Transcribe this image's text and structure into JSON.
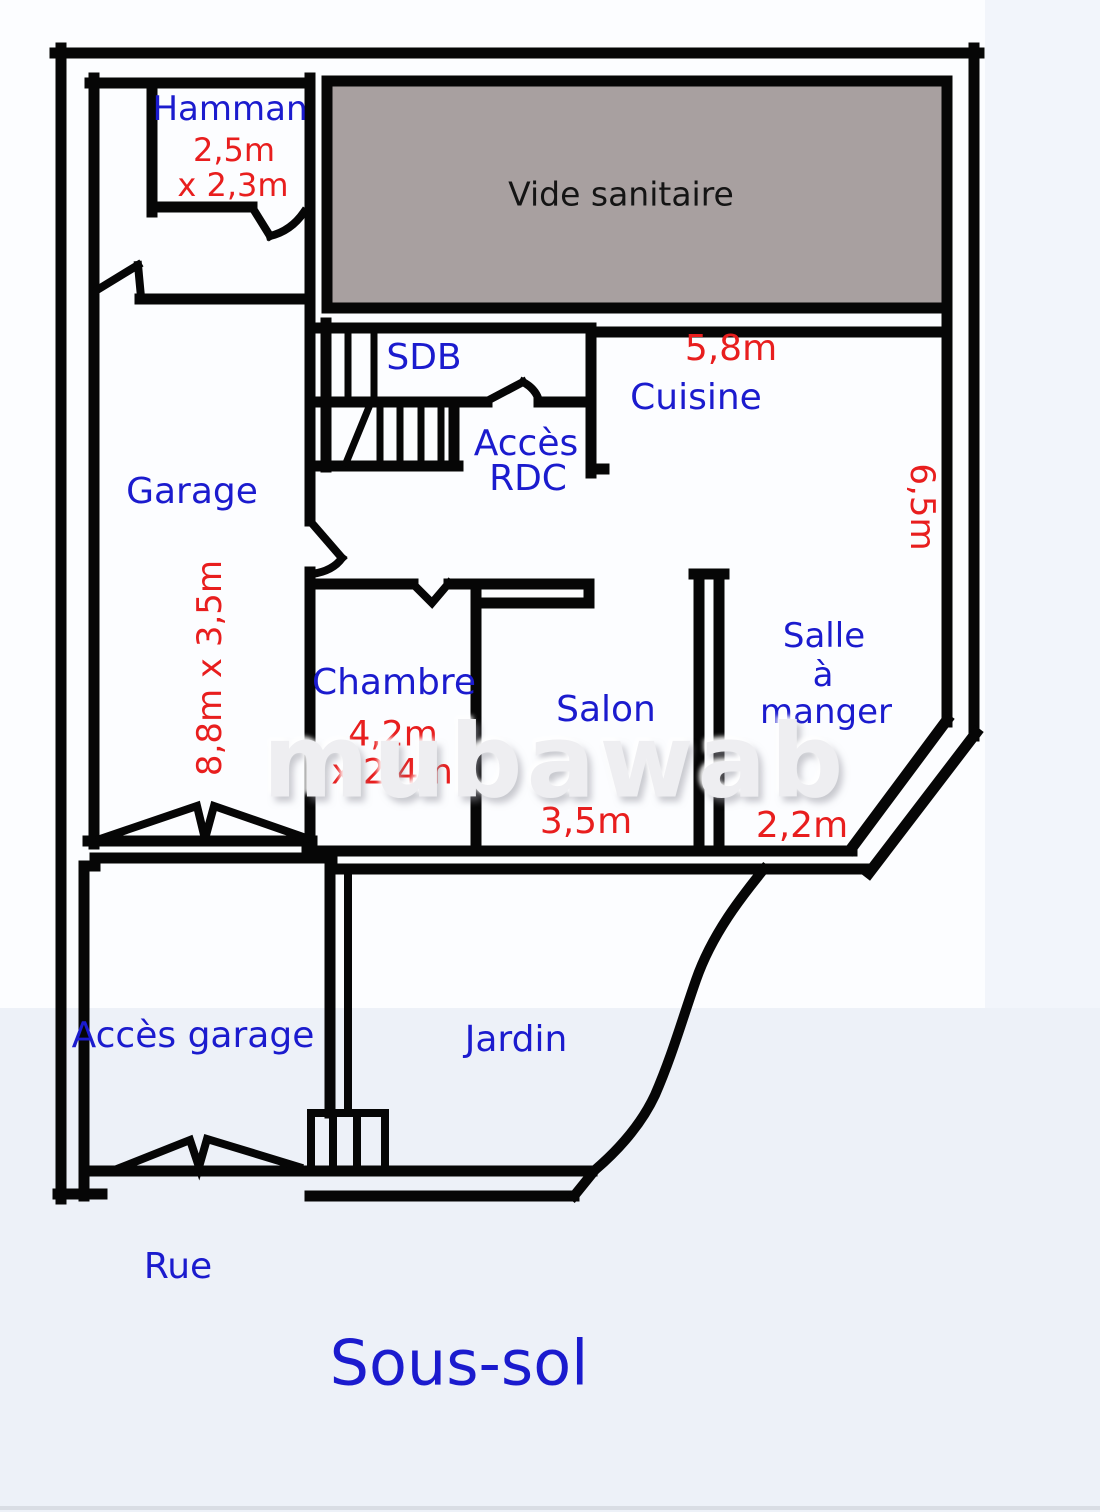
{
  "title": "Sous-sol",
  "watermark": "mubawab",
  "colors": {
    "room_label_blue": "#1b1bce",
    "dimension_red": "#e81e1e",
    "wall_black": "#060606",
    "vide_sanitaire_fill": "#a8a0a0",
    "vide_sanitaire_label": "#141414",
    "background_tint": "#edf1f8"
  },
  "rooms": {
    "hamman": {
      "name": "Hamman",
      "dim_line1": "2,5m",
      "dim_line2": "x 2,3m"
    },
    "vide_sanitaire": {
      "name": "Vide sanitaire"
    },
    "sdb": {
      "name": "SDB"
    },
    "acces_rdc": {
      "line1": "Accès",
      "line2": "RDC"
    },
    "cuisine": {
      "name": "Cuisine",
      "width": "5,8m",
      "depth": "6,5m"
    },
    "garage": {
      "name": "Garage",
      "dims": "8,8m x 3,5m"
    },
    "chambre": {
      "name": "Chambre",
      "dim_line1": "4,2m",
      "dim_line2": "x 2,4m"
    },
    "salon": {
      "name": "Salon",
      "width": "3,5m"
    },
    "salle_a_manger": {
      "line1": "Salle",
      "line2": "à",
      "line3": "manger",
      "width": "2,2m"
    },
    "acces_garage": {
      "name": "Accès garage"
    },
    "jardin": {
      "name": "Jardin"
    },
    "rue": {
      "name": "Rue"
    }
  }
}
